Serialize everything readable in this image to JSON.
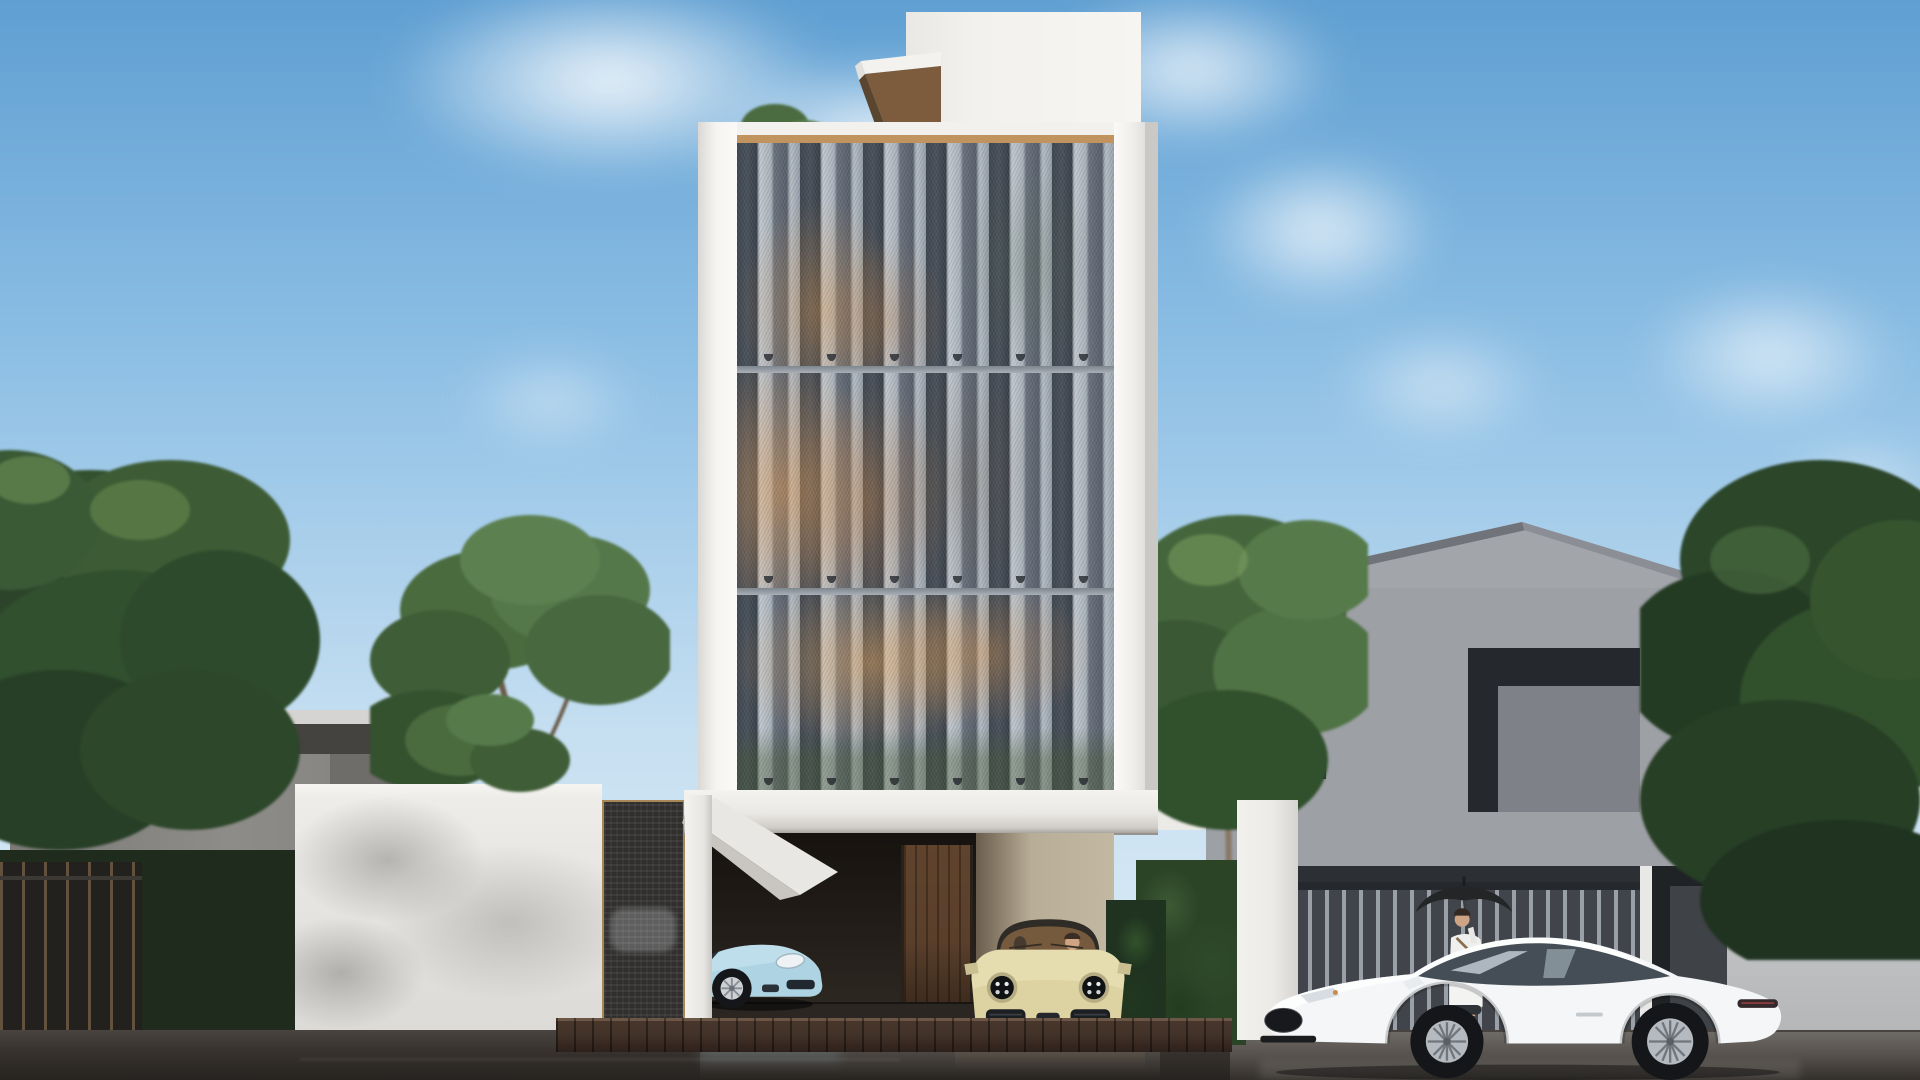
{
  "scene": {
    "type": "architectural-exterior-render",
    "time_of_day": "daytime, partly cloudy, wet street",
    "main_building": {
      "style": "modern white 4-storey townhouse",
      "facade": "three bands of folded perforated-mesh screen panels with warm interior light",
      "roof": "white penthouse box and wooden canopy",
      "ground": "open carport with wooden door, beige Porsche 911 parked inside, baby-blue Porsche in left bay"
    },
    "left_neighbor": {
      "building": "grey flat-roof house",
      "fence": "dark curved-bar fence",
      "wall": "white wall with tree shadows and dark mesh gate"
    },
    "right_neighbor": {
      "building": "grey gable-roof house with recessed dark openings",
      "gate": "vertical slat gate",
      "wall": "light grey wall"
    },
    "vehicles": [
      {
        "name": "porsche-coupe",
        "color_key": "car_blue",
        "view": "front three-quarter, nose right, behind left bay"
      },
      {
        "name": "porsche-911",
        "color_key": "car_beige",
        "view": "front, two occupants visible, parked in carport"
      },
      {
        "name": "jaguar-f-type",
        "color_key": "car_white",
        "view": "side profile facing left, parked on street"
      }
    ],
    "people": [
      {
        "name": "woman-with-umbrella",
        "clothing_key": "outfit_white",
        "umbrella_key": "umbrella",
        "position": "behind white coupe, in front of slat gate"
      }
    ],
    "vegetation": [
      "left tree cluster",
      "mid-left trees with trunks",
      "sprig above parapet",
      "tree right of tower",
      "far-right tree mass",
      "hedges"
    ],
    "street": "dark wet asphalt with reflections, brick curb driveway edge"
  },
  "palette": {
    "sky_top": "#5f9fd2",
    "sky_mid": "#8fc0e5",
    "sky_low": "#c6dff1",
    "sky_horizon": "#e2eef7",
    "cloud": "#ffffff",
    "building_white": "#f2f1ee",
    "building_shadow": "#cfccc7",
    "trim_wood": "#c0935f",
    "canopy_wood": "#7c5c3d",
    "mesh_dark": "#3f4751",
    "mesh_mid": "#656f7b",
    "mesh_light": "#c2c9d0",
    "mullion": "#8d959e",
    "glow_warm": "#e69a50",
    "planter_green": "#4c6234",
    "carport_dark": "#1d1814",
    "carport_wall": "#c3b8a2",
    "door_wood": "#5a3f2b",
    "left_house_wall": "#8e8c89",
    "left_house_fascia": "#45433f",
    "left_house_roof": "#d5d4d2",
    "fence_dark": "#23211e",
    "fence_bar": "#c8a06c",
    "wall_white": "#edece8",
    "wall_shadow": "#b7b5b1",
    "gate_mesh": "#302f2d",
    "gate_frame": "#a78755",
    "pillar_white": "#eceae6",
    "right_house_wall": "#9da0a5",
    "right_house_gable": "#a2a5aa",
    "right_house_dark": "#2c2f33",
    "right_recess": "#25282d",
    "recess_panel": "#7e8187",
    "slat_bg": "#41444a",
    "slat_light": "#99a0a7",
    "right_wall_light": "#c6c8ca",
    "tree_dark": "#2b4629",
    "tree_mid": "#45663c",
    "tree_light": "#6f9153",
    "trunk": "#6b5b49",
    "street_light": "#4a4440",
    "street_dark": "#262320",
    "curb_brick": "#43332a",
    "car_blue": "#aed3e3",
    "car_beige": "#ddd3a2",
    "car_white": "#f4f6f8",
    "tire": "#141619",
    "rim": "#b4babf",
    "umbrella": "#232527",
    "skin": "#cfa485",
    "outfit_white": "#eff0ee"
  }
}
